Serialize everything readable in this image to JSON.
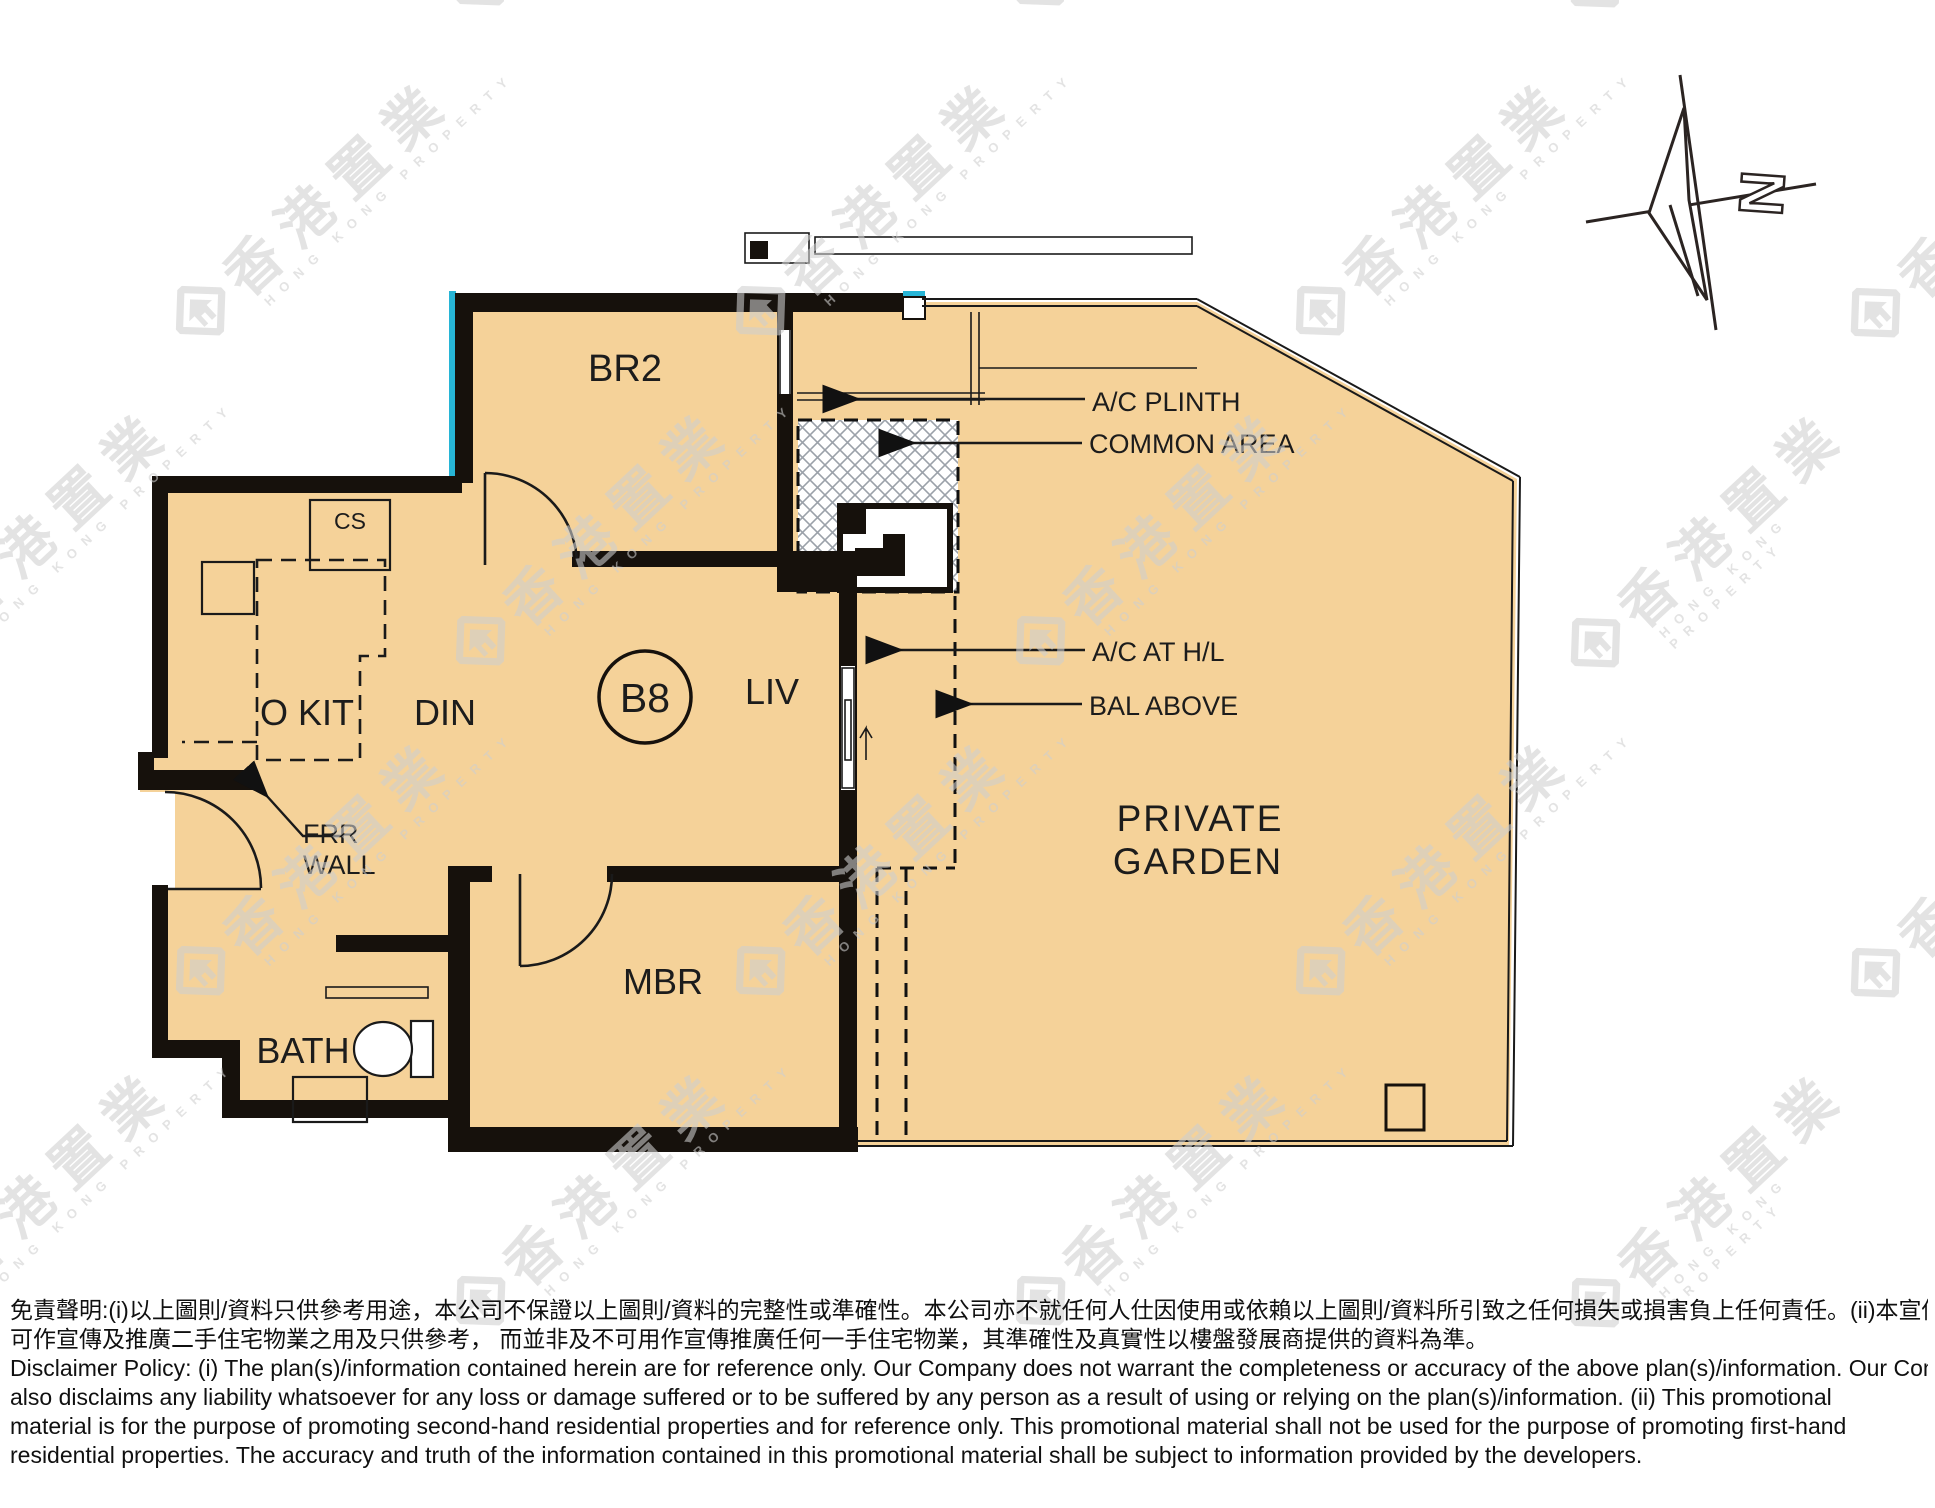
{
  "plan": {
    "unit_label": "B8",
    "rooms": {
      "br2": "BR2",
      "open_kitchen": "O KIT",
      "dining": "DIN",
      "living": "LIV",
      "master_bedroom": "MBR",
      "bathroom": "BATH",
      "cabinet": "CS",
      "private_garden_line1": "PRIVATE",
      "private_garden_line2": "GARDEN"
    },
    "annotations": {
      "ac_plinth": "A/C PLINTH",
      "common_area": "COMMON AREA",
      "ac_at_hl": "A/C AT H/L",
      "bal_above": "BAL ABOVE",
      "frr_line1": "FRR",
      "frr_line2": "WALL"
    },
    "compass_letter": "N"
  },
  "watermark": {
    "cjk": "香港置業",
    "latin": "HONG KONG PROPERTY"
  },
  "disclaimer": {
    "lines": [
      "免責聲明:(i)以上圖則/資料只供參考用途，本公司不保證以上圖則/資料的完整性或準確性。本公司亦不就任何人仕因使用或依賴以上圖則/資料所引致之任何損失或損害負上任何責任。(ii)本宣傳資料只",
      "可作宣傳及推廣二手住宅物業之用及只供參考， 而並非及不可用作宣傳推廣任何一手住宅物業，其準確性及真實性以樓盤發展商提供的資料為準。",
      "Disclaimer Policy: (i) The plan(s)/information contained herein are for reference only. Our Company does not warrant the completeness or accuracy of the above plan(s)/information. Our Company",
      "also disclaims any liability whatsoever for any loss or damage suffered or to be suffered by any person as a result of using or relying on the plan(s)/information. (ii) This promotional",
      "material is for the purpose of promoting second-hand residential properties and for reference only. This promotional material shall not be used for the purpose of promoting first-hand",
      "residential properties. The accuracy and truth of the information contained in this promotional material shall be subject to information provided by the developers."
    ]
  },
  "colors": {
    "floor_fill": "#F5D299",
    "wall": "#16110C",
    "accent_cyan": "#27B5D6",
    "hatch_line": "#9BA1A9",
    "watermark_gray": "#CFCFCF"
  }
}
